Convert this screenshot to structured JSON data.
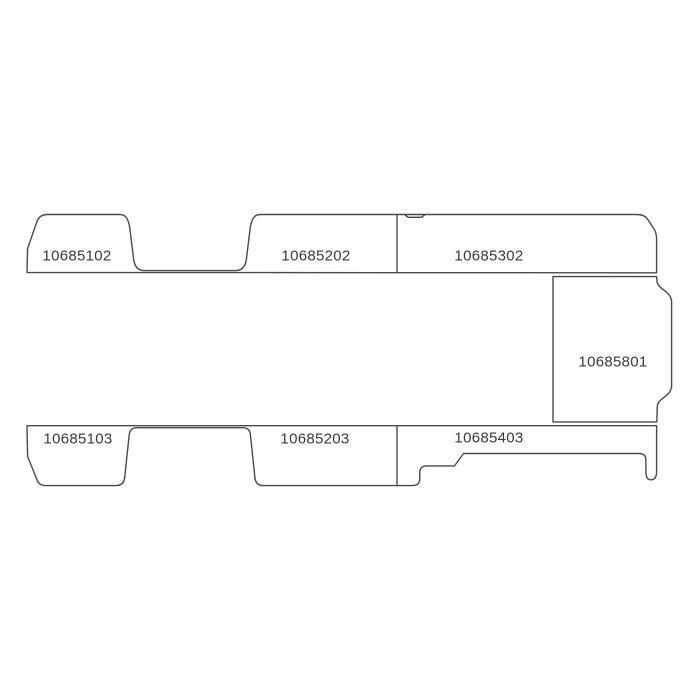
{
  "diagram": {
    "panels": [
      {
        "position": "top-left",
        "label": "10685102"
      },
      {
        "position": "top-middle",
        "label": "10685202"
      },
      {
        "position": "top-right",
        "label": "10685302"
      },
      {
        "position": "right-side",
        "label": "10685801"
      },
      {
        "position": "bottom-left",
        "label": "10685103"
      },
      {
        "position": "bottom-middle",
        "label": "10685203"
      },
      {
        "position": "bottom-right",
        "label": "10685403"
      }
    ]
  },
  "colors": {
    "background": "#ffffff",
    "line": "#4a4a4a",
    "text": "#3a3a3a"
  }
}
